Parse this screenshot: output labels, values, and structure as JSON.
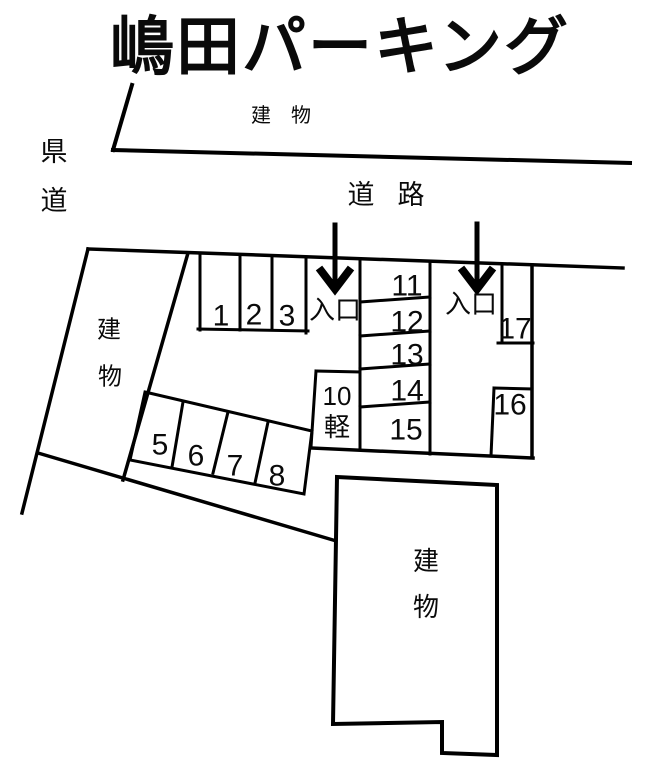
{
  "canvas": {
    "width": 654,
    "height": 768,
    "background": "#ffffff",
    "ink": "#000000"
  },
  "title": "嶋田パーキング",
  "roads": {
    "prefectural_road": [
      "県",
      "道"
    ],
    "road": "道　路"
  },
  "buildings": {
    "top": "建　物",
    "left": [
      "建",
      "物"
    ],
    "bottom": [
      "建",
      "物"
    ]
  },
  "entrances": {
    "left": "入口",
    "right": "入口"
  },
  "spaces": {
    "top_row": [
      "1",
      "2",
      "3"
    ],
    "diagonal_row": [
      "5",
      "6",
      "7",
      "8"
    ],
    "kei": {
      "number": "10",
      "type": "軽"
    },
    "right_column": [
      "11",
      "12",
      "13",
      "14",
      "15"
    ],
    "s16": "16",
    "s17": "17"
  }
}
